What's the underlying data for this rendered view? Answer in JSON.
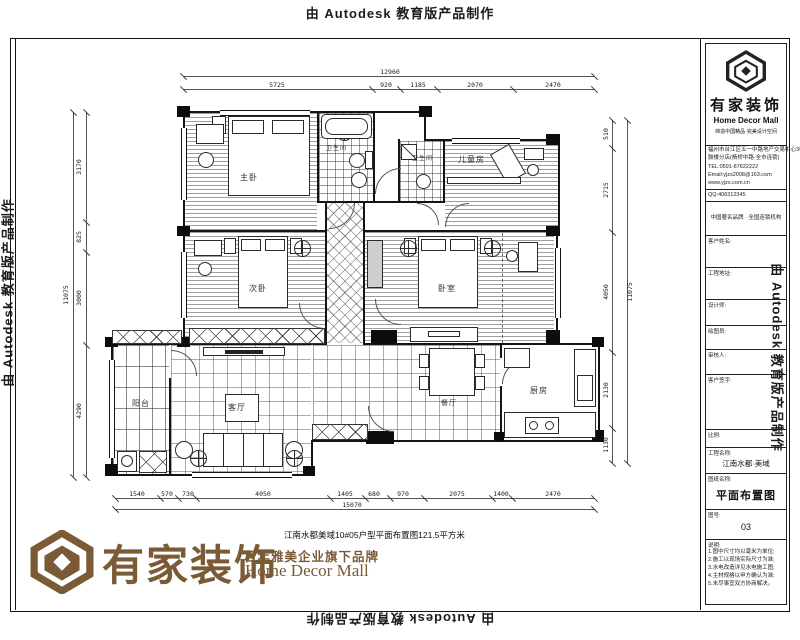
{
  "watermark": "由 Autodesk 教育版产品制作",
  "logo": {
    "cn": "有家装饰",
    "sub": "百年雅美企业旗下品牌",
    "en": "Home Decor Mall",
    "tagline": "缔造中国精品·完美设计空间",
    "project_line": "江南水都美域10#05户型平面布置图121.5平方米"
  },
  "titleblock": {
    "addr1": "福州市台江区五一中路地产交易中心3楼",
    "addr2": "鼓楼分店(杨桥中路·全市连锁)",
    "tel": "TEL:0591-87622222",
    "email": "Email:yjzs2008@163.com",
    "web": "www.yjzs.com.cn",
    "qq": "QQ:406312345",
    "brand_row": "中国著名品牌 · 全国连锁机构",
    "rows": [
      "客户姓名:",
      "工程地址:",
      "设计师:",
      "绘图员:",
      "审核人:",
      "客户签字:"
    ],
    "scale_label": "比例:",
    "project_label": "工程名称:",
    "project_value": "江南水都·美域",
    "sheet_label": "图纸名称:",
    "sheet_value": "平面布置图",
    "no_label": "图号:",
    "no_value": "03",
    "notes_label": "说明:",
    "notes": [
      "1.图中尺寸均以毫米为单位;",
      "2.施工以现场实际尺寸为准;",
      "3.水电改造详见水电施工图;",
      "4.主材规格以甲方确认为准;",
      "5.未尽事宜双方协商解决。"
    ]
  },
  "rooms": {
    "master": "主卧",
    "bath1": "卫生间",
    "bath2": "卫生间",
    "kids": "儿童房",
    "bed2": "次卧",
    "bed3": "卧室",
    "living": "客厅",
    "dining": "餐厅",
    "kitchen": "厨房",
    "balcony": "阳台"
  },
  "dims": {
    "top": {
      "total": "12960",
      "segs": [
        "5725",
        "920",
        "1185",
        "2070",
        "2470"
      ]
    },
    "bottom": {
      "total": "15070",
      "segs": [
        "1540",
        "570",
        "730",
        "4050",
        "1405",
        "680",
        "970",
        "2075",
        "1400",
        "2470"
      ]
    },
    "left": {
      "total": "11075",
      "segs": [
        "3170",
        "825",
        "3000",
        "4290"
      ]
    },
    "right": {
      "total": "11075",
      "segs": [
        "510",
        "2715",
        "4050",
        "2130",
        "1130"
      ]
    }
  },
  "colors": {
    "brand": "#7b5a36"
  }
}
